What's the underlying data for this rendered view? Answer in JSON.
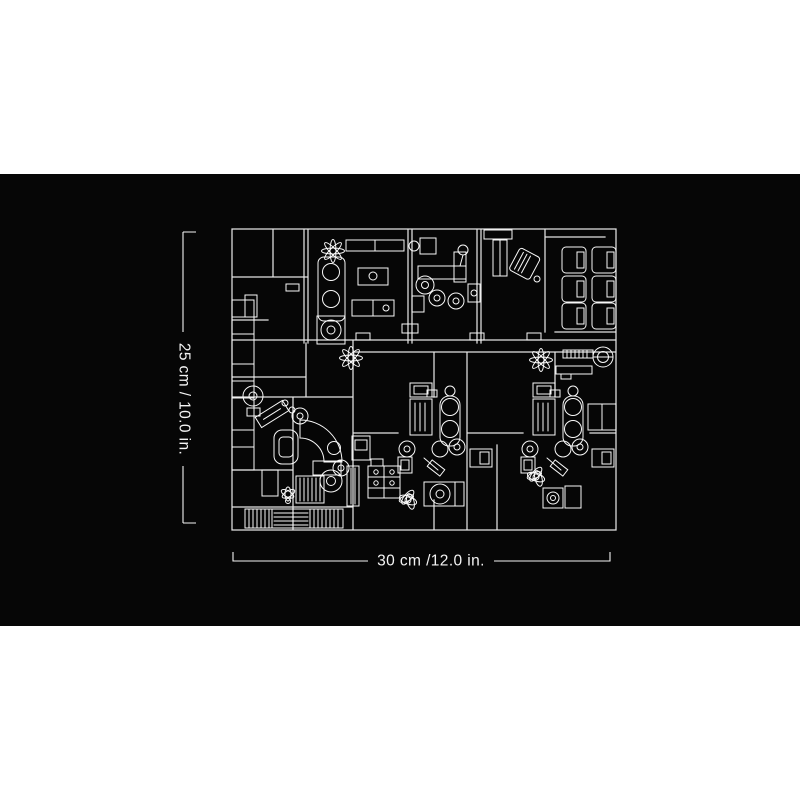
{
  "colors": {
    "page_background": "#ffffff",
    "image_background": "#060606",
    "line": "#e4e4e4",
    "furniture": "#f8f8f8",
    "text": "#f4f4f4"
  },
  "figure": {
    "type": "floor-plan-dimension-diagram",
    "description": "Black product image with white line-art building floor plan and size annotations",
    "dimensions": {
      "height_label": "25 cm / 10.0 in.",
      "width_label": "30 cm /12.0 in."
    },
    "features": [
      "lounge",
      "office",
      "consult-room",
      "waiting-room",
      "corridor",
      "treatment-bay-left",
      "treatment-bay-middle",
      "treatment-bay-right",
      "staircase",
      "plants"
    ]
  }
}
